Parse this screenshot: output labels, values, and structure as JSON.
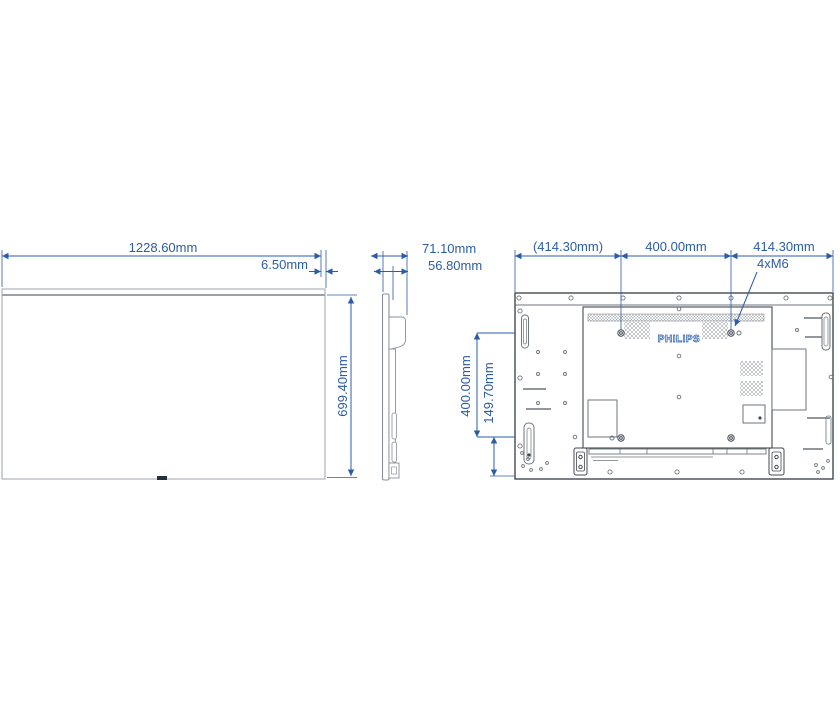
{
  "drawing": {
    "brand": "PHILIPS",
    "front_view": {
      "width_label": "1228.60mm",
      "bezel_label": "6.50mm",
      "height_label": "699.40mm"
    },
    "side_view": {
      "depth_total_label": "71.10mm",
      "depth_body_label": "56.80mm"
    },
    "rear_view": {
      "dim_left_label": "(414.30mm)",
      "dim_center_label": "400.00mm",
      "dim_right_label": "414.30mm",
      "mount_screw_label": "4xM6",
      "vesa_vertical_label": "400.00mm",
      "bottom_offset_label": "149.70mm"
    },
    "colors": {
      "dimension_blue": "#2b5ca7",
      "outline_dark": "#434a54",
      "outline_light": "#8a9099"
    }
  }
}
